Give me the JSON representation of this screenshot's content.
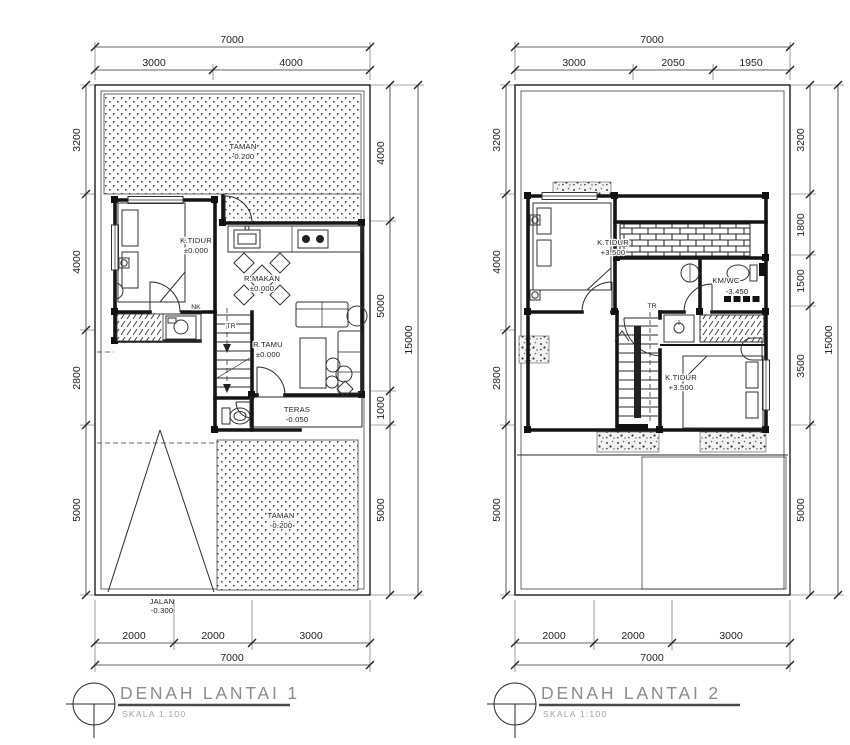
{
  "drawing": {
    "line_color": "#1c1c1c",
    "title_color": "#8c8c8c"
  },
  "plan1": {
    "title": "DENAH LANTAI 1",
    "scale": "SKALA 1:100",
    "dim": {
      "top_total": "7000",
      "top": [
        "3000",
        "4000"
      ],
      "left": [
        "3200",
        "4000",
        "2800",
        "5000"
      ],
      "right": [
        "4000",
        "5000",
        "1000",
        "5000"
      ],
      "side_total": "15000",
      "bottom": [
        "2000",
        "2000",
        "3000"
      ],
      "bottom_total": "7000"
    },
    "rooms": {
      "garden_top": {
        "name": "TAMAN",
        "elev": "-0.200"
      },
      "bedroom": {
        "name": "K.TIDUR",
        "elev": "±0.000"
      },
      "dining": {
        "name": "R.MAKAN",
        "elev": "±0.000"
      },
      "living": {
        "name": "R.TAMU",
        "elev": "±0.000"
      },
      "terrace": {
        "name": "TERAS",
        "elev": "-0.050"
      },
      "garden_bottom": {
        "name": "TAMAN",
        "elev": "-0.200"
      },
      "road": {
        "name": "JALAN",
        "elev": "-0.300"
      }
    },
    "stair_labels": {
      "up": "NK",
      "tr": "TR"
    }
  },
  "plan2": {
    "title": "DENAH LANTAI 2",
    "scale": "SKALA 1:100",
    "dim": {
      "top_total": "7000",
      "top": [
        "3000",
        "2050",
        "1950"
      ],
      "left": [
        "3200",
        "4000",
        "2800",
        "5000"
      ],
      "right": [
        "3200",
        "1800",
        "1500",
        "3500",
        "5000"
      ],
      "side_total": "15000",
      "bottom": [
        "2000",
        "2000",
        "3000"
      ],
      "bottom_total": "7000"
    },
    "rooms": {
      "bedroom1": {
        "name": "K.TIDUR",
        "elev": "+3.500"
      },
      "bathroom": {
        "name": "KM/WC",
        "elev": "-3.450"
      },
      "bedroom2": {
        "name": "K.TIDUR",
        "elev": "+3.500"
      }
    },
    "stair_labels": {
      "tr": "TR"
    }
  }
}
